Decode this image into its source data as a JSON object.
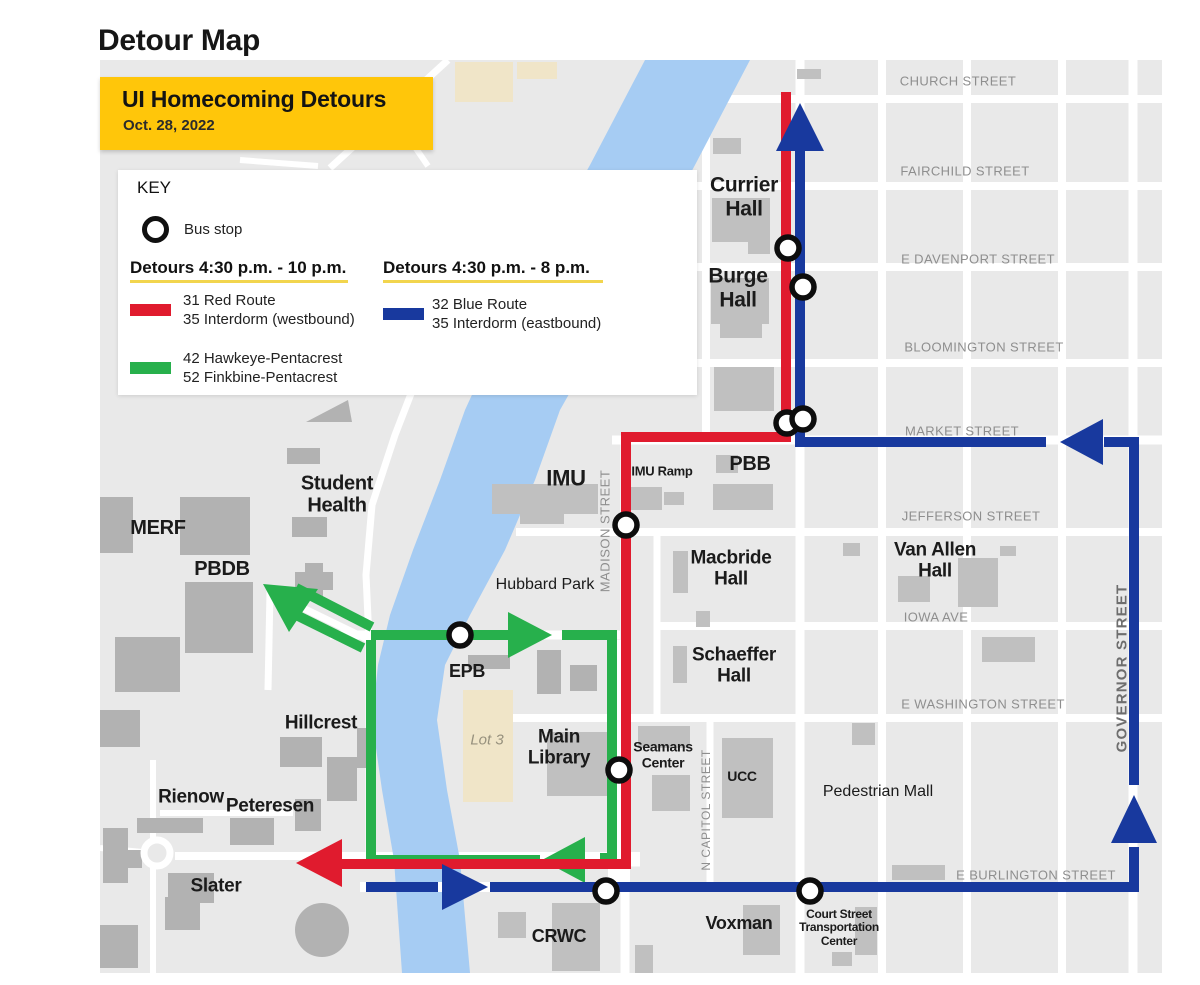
{
  "page": {
    "title": "Detour Map"
  },
  "banner": {
    "title": "UI Homecoming Detours",
    "date": "Oct. 28, 2022"
  },
  "key": {
    "heading": "KEY",
    "bus_stop": "Bus stop",
    "col1_heading": "Detours 4:30 p.m. - 10 p.m.",
    "col2_heading": "Detours 4:30 p.m. - 8 p.m.",
    "red_route": [
      "31 Red Route",
      "35 Interdorm (westbound)"
    ],
    "blue_route": [
      "32 Blue Route",
      "35 Interdorm (eastbound)"
    ],
    "green_route": [
      "42 Hawkeye-Pentacrest",
      "52 Finkbine-Pentacrest"
    ]
  },
  "colors": {
    "red": "#E01B2E",
    "blue": "#18399E",
    "green": "#27B04C",
    "river": "#A6CCF3",
    "gold": "#FFC60A",
    "lot_beige": "#F0E5C8"
  },
  "map": {
    "streets": {
      "church": "CHURCH STREET",
      "fairchild": "FAIRCHILD STREET",
      "davenport": "E DAVENPORT STREET",
      "bloomington": "BLOOMINGTON STREET",
      "market": "MARKET STREET",
      "jefferson": "JEFFERSON STREET",
      "iowa": "IOWA AVE",
      "washington": "E WASHINGTON STREET",
      "burlington": "E BURLINGTON STREET",
      "madison": "MADISON STREET",
      "ncapitol": "N CAPITOL STREET",
      "governor": "GOVERNOR STREET"
    },
    "places": {
      "currier": "Currier Hall",
      "burge": "Burge Hall",
      "pbb": "PBB",
      "imu": "IMU",
      "imu_ramp": "IMU Ramp",
      "student_health": "Student Health",
      "merf": "MERF",
      "pbdb": "PBDB",
      "hubbard_park": "Hubbard Park",
      "macbride": "Macbride Hall",
      "van_allen": "Van Allen Hall",
      "schaeffer": "Schaeffer Hall",
      "epb": "EPB",
      "hillcrest": "Hillcrest",
      "lot3": "Lot 3",
      "main_library": "Main Library",
      "seamans": "Seamans Center",
      "ucc": "UCC",
      "ped_mall": "Pedestrian Mall",
      "rienow": "Rienow",
      "peteresen": "Peteresen",
      "slater": "Slater",
      "crwc": "CRWC",
      "voxman": "Voxman",
      "court_tc": "Court Street Transportation Center"
    }
  }
}
